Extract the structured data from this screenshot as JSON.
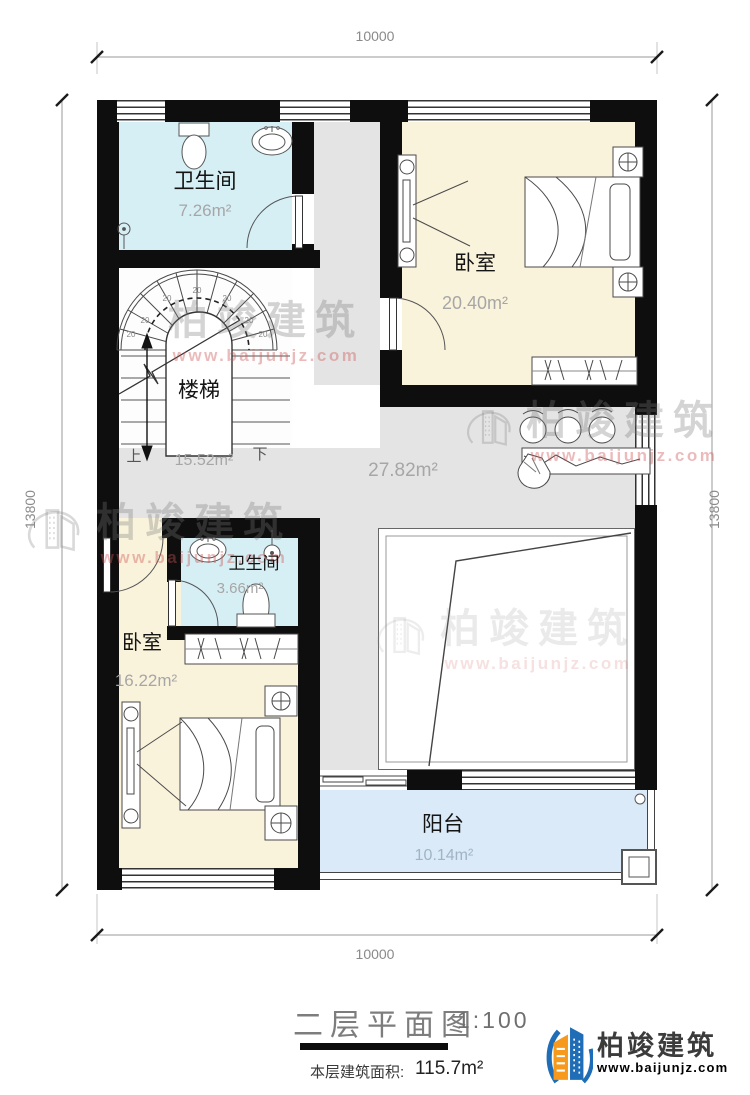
{
  "dimensions": {
    "top": "10000",
    "bottom": "10000",
    "left": "13800",
    "right": "13800"
  },
  "rooms": {
    "bath1": {
      "name": "卫生间",
      "area": "7.26m²"
    },
    "bed1": {
      "name": "卧室",
      "area": "20.40m²"
    },
    "stairs": {
      "name": "楼梯",
      "area": "15.52m²",
      "up": "上",
      "down": "下",
      "tread": "20"
    },
    "hall": {
      "area": "27.82m²"
    },
    "bath2": {
      "name": "卫生间",
      "area": "3.66m²"
    },
    "bed2": {
      "name": "卧室",
      "area": "16.22m²"
    },
    "balcony": {
      "name": "阳台",
      "area": "10.14m²"
    }
  },
  "title": {
    "text": "二层平面图",
    "scale": "1:100",
    "area_label": "本层建筑面积:",
    "area_value": "115.7m²"
  },
  "brand": {
    "name": "柏竣建筑",
    "url": "www.baijunjz.com"
  },
  "watermark": {
    "text": "柏竣建筑",
    "url": "www.baijunjz.com"
  },
  "colors": {
    "wall": "#0e0e0e",
    "bathroom": "#d6eff5",
    "bedroom": "#faf3dc",
    "hall": "#e4e4e4",
    "balcony": "#daeaf8",
    "brand_blue": "#1e6db6",
    "brand_orange": "#f6991d"
  }
}
